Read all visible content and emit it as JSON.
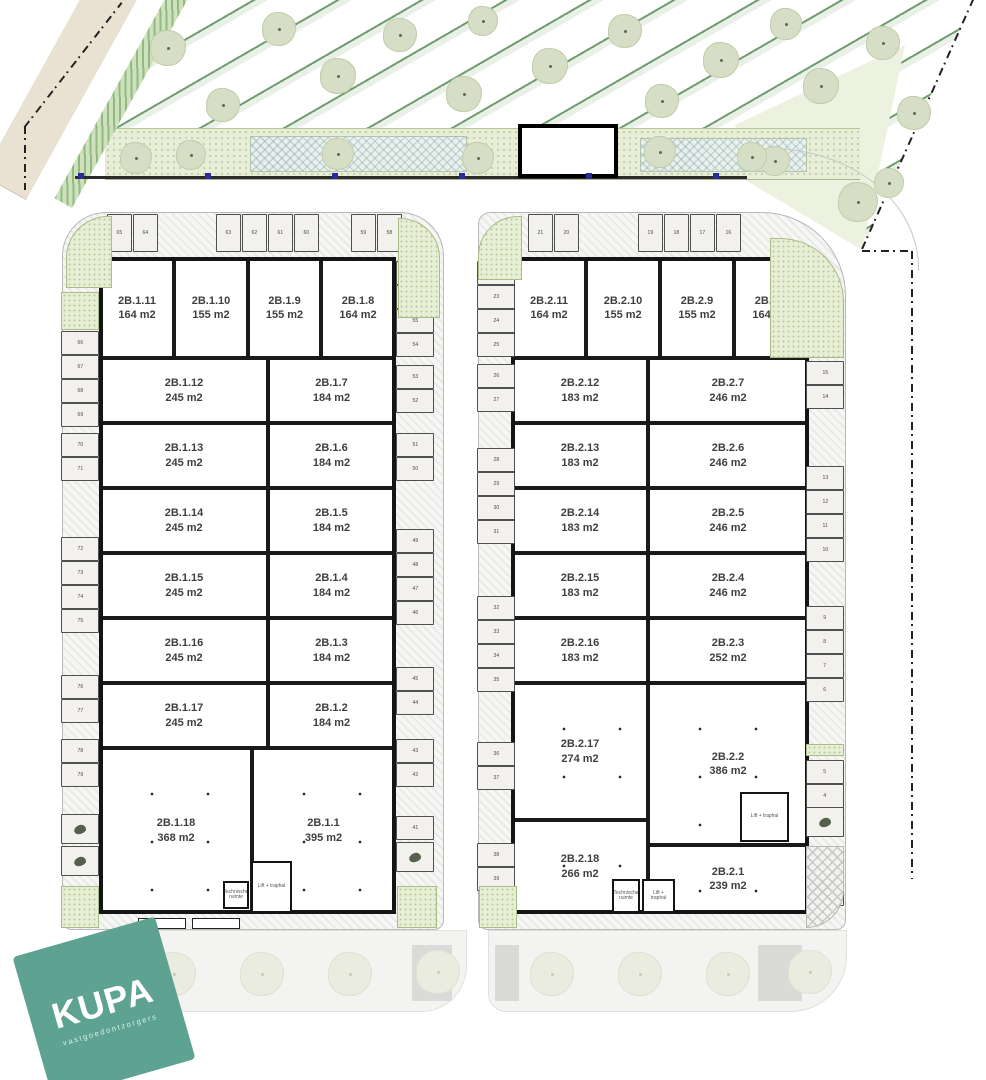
{
  "colors": {
    "stripe_green": "#6f9d6f",
    "planting_green": "#e7edd6",
    "logo_teal": "#5ea291",
    "wall_black": "#1a1a1a"
  },
  "logo": {
    "text": "KUPA",
    "subtext": "vastgoedontzorgers"
  },
  "annotations": {
    "technical_room": "Technische ruimte",
    "lift_room": "Lift + traphal"
  },
  "building1": {
    "top_units": [
      {
        "name": "2B.1.11",
        "area": "164 m2"
      },
      {
        "name": "2B.1.10",
        "area": "155 m2"
      },
      {
        "name": "2B.1.9",
        "area": "155 m2"
      },
      {
        "name": "2B.1.8",
        "area": "164 m2"
      }
    ],
    "mid_rows": [
      {
        "left": {
          "name": "2B.1.12",
          "area": "245 m2"
        },
        "right": {
          "name": "2B.1.7",
          "area": "184 m2"
        }
      },
      {
        "left": {
          "name": "2B.1.13",
          "area": "245 m2"
        },
        "right": {
          "name": "2B.1.6",
          "area": "184 m2"
        }
      },
      {
        "left": {
          "name": "2B.1.14",
          "area": "245 m2"
        },
        "right": {
          "name": "2B.1.5",
          "area": "184 m2"
        }
      },
      {
        "left": {
          "name": "2B.1.15",
          "area": "245 m2"
        },
        "right": {
          "name": "2B.1.4",
          "area": "184 m2"
        }
      },
      {
        "left": {
          "name": "2B.1.16",
          "area": "245 m2"
        },
        "right": {
          "name": "2B.1.3",
          "area": "184 m2"
        }
      },
      {
        "left": {
          "name": "2B.1.17",
          "area": "245 m2"
        },
        "right": {
          "name": "2B.1.2",
          "area": "184 m2"
        }
      }
    ],
    "bottom_units": [
      {
        "name": "2B.1.18",
        "area": "368 m2"
      },
      {
        "name": "2B.1.1",
        "area": "395 m2"
      }
    ],
    "parking": {
      "top": [
        [
          "65",
          "64"
        ],
        [
          "63",
          "62",
          "61",
          "60"
        ],
        [
          "59",
          "58"
        ]
      ],
      "left": [
        [
          "66",
          "67",
          "68",
          "69"
        ],
        [
          "70",
          "71"
        ],
        [
          "72",
          "73",
          "74",
          "75"
        ],
        [
          "76",
          "77"
        ],
        [
          "78",
          "79"
        ]
      ],
      "right": [
        [
          "57",
          "56",
          "55",
          "54"
        ],
        [
          "53",
          "52"
        ],
        [
          "51",
          "50"
        ],
        [
          "49",
          "48",
          "47",
          "46"
        ],
        [
          "45",
          "44"
        ],
        [
          "43",
          "42"
        ],
        [
          "41"
        ]
      ]
    }
  },
  "building2": {
    "top_units": [
      {
        "name": "2B.2.11",
        "area": "164 m2"
      },
      {
        "name": "2B.2.10",
        "area": "155 m2"
      },
      {
        "name": "2B.2.9",
        "area": "155 m2"
      },
      {
        "name": "2B.2.8",
        "area": "164 m2"
      }
    ],
    "mid_rows": [
      {
        "left": {
          "name": "2B.2.12",
          "area": "183 m2"
        },
        "right": {
          "name": "2B.2.7",
          "area": "246 m2"
        }
      },
      {
        "left": {
          "name": "2B.2.13",
          "area": "183 m2"
        },
        "right": {
          "name": "2B.2.6",
          "area": "246 m2"
        }
      },
      {
        "left": {
          "name": "2B.2.14",
          "area": "183 m2"
        },
        "right": {
          "name": "2B.2.5",
          "area": "246 m2"
        }
      },
      {
        "left": {
          "name": "2B.2.15",
          "area": "183 m2"
        },
        "right": {
          "name": "2B.2.4",
          "area": "246 m2"
        }
      },
      {
        "left": {
          "name": "2B.2.16",
          "area": "183 m2"
        },
        "right": {
          "name": "2B.2.3",
          "area": "252 m2"
        }
      }
    ],
    "tall_row": {
      "left": {
        "name": "2B.2.17",
        "area": "274 m2"
      },
      "right": {
        "name": "2B.2.2",
        "area": "386 m2"
      }
    },
    "bottom_row": {
      "left": {
        "name": "2B.2.18",
        "area": "266 m2"
      },
      "right": {
        "name": "2B.2.1",
        "area": "239 m2"
      }
    },
    "parking": {
      "top": [
        [
          "21",
          "20"
        ],
        [
          "19",
          "18",
          "17",
          "16"
        ]
      ],
      "left": [
        [
          "22",
          "23",
          "24",
          "25"
        ],
        [
          "26",
          "27"
        ],
        [
          "28",
          "29",
          "30",
          "31"
        ],
        [
          "32",
          "33",
          "34",
          "35"
        ],
        [
          "36",
          "37"
        ],
        [
          "38",
          "39"
        ]
      ],
      "right": [
        [
          "15",
          "14"
        ],
        [
          "13",
          "12",
          "11",
          "10"
        ],
        [
          "9",
          "8",
          "7",
          "6"
        ],
        [
          "5",
          "4"
        ],
        [
          "1"
        ]
      ]
    }
  }
}
